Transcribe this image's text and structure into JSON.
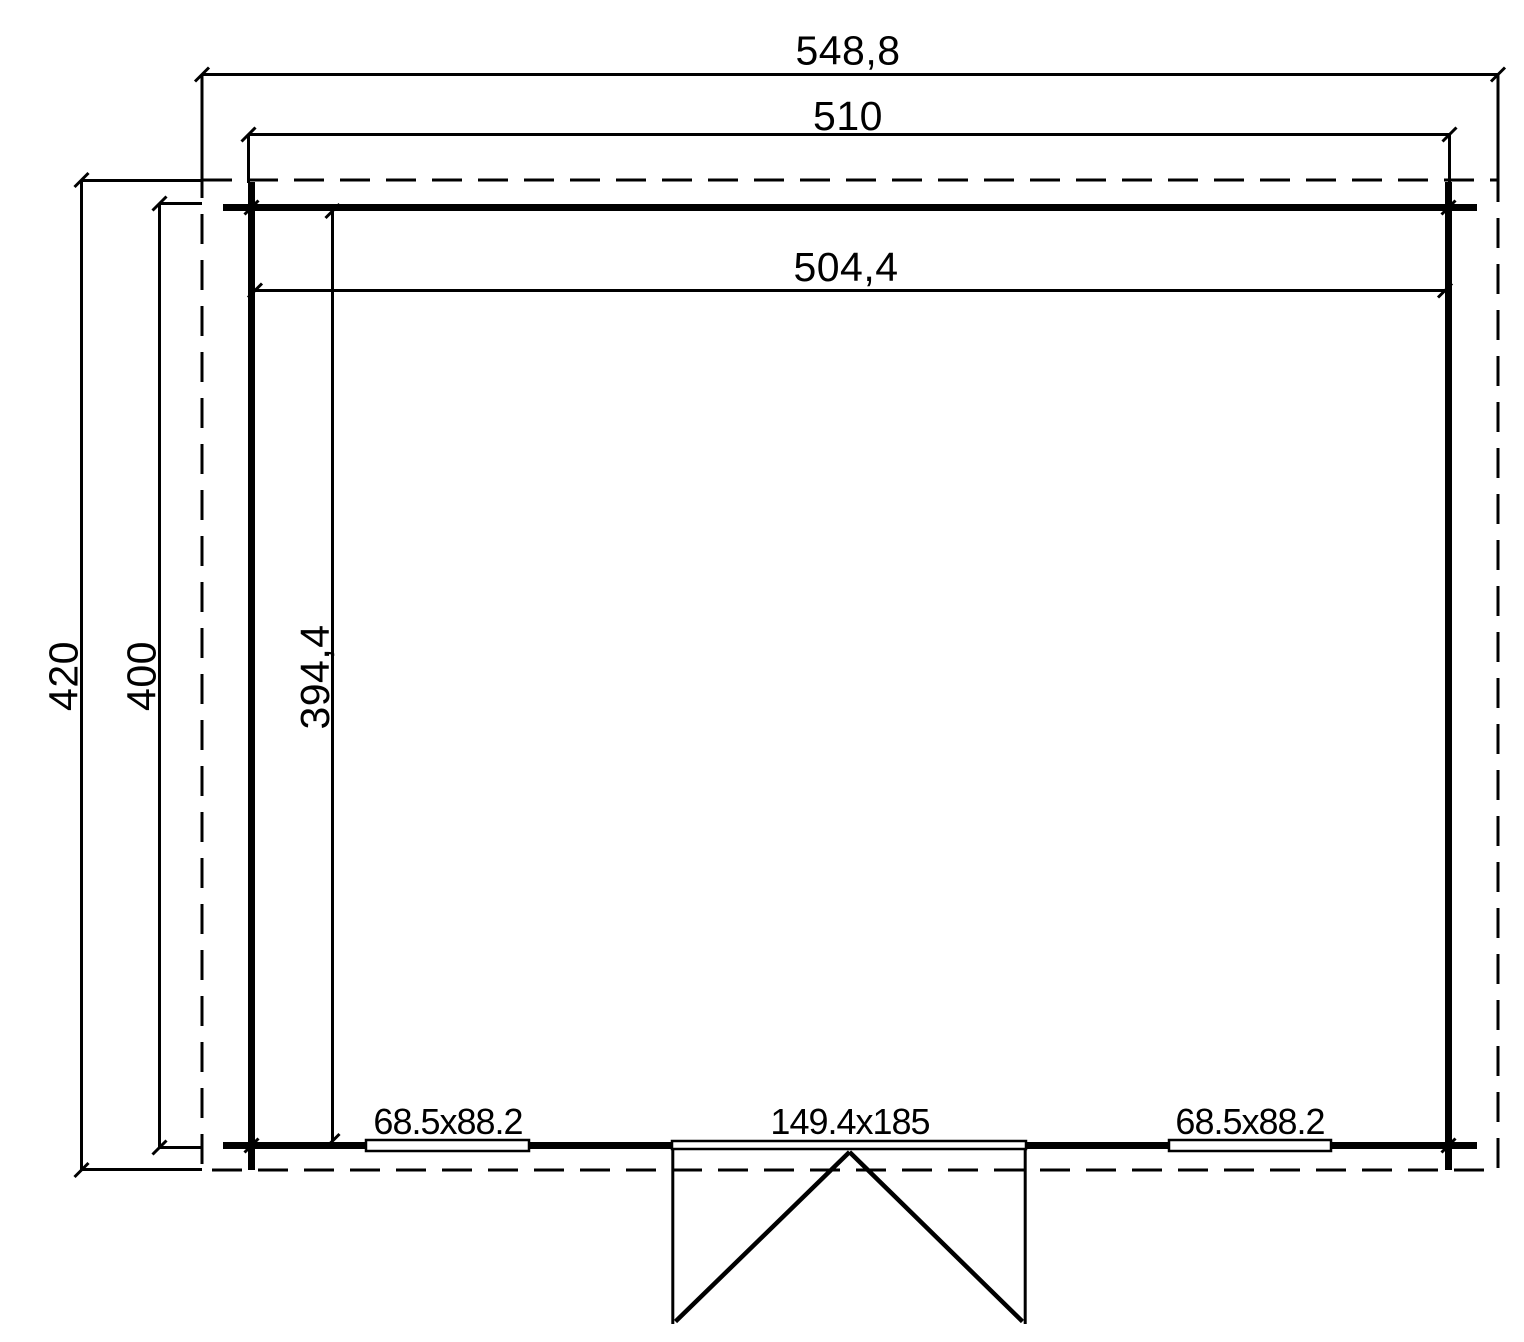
{
  "colors": {
    "line": "#000000",
    "background": "#ffffff"
  },
  "dimensions": {
    "roof_width": "548,8",
    "wall_width": "510",
    "interior_width": "504,4",
    "roof_depth": "420",
    "wall_depth": "400",
    "interior_depth": "394,4"
  },
  "openings": {
    "window_left": "68.5x88.2",
    "door": "149.4x185",
    "window_right": "68.5x88.2"
  }
}
